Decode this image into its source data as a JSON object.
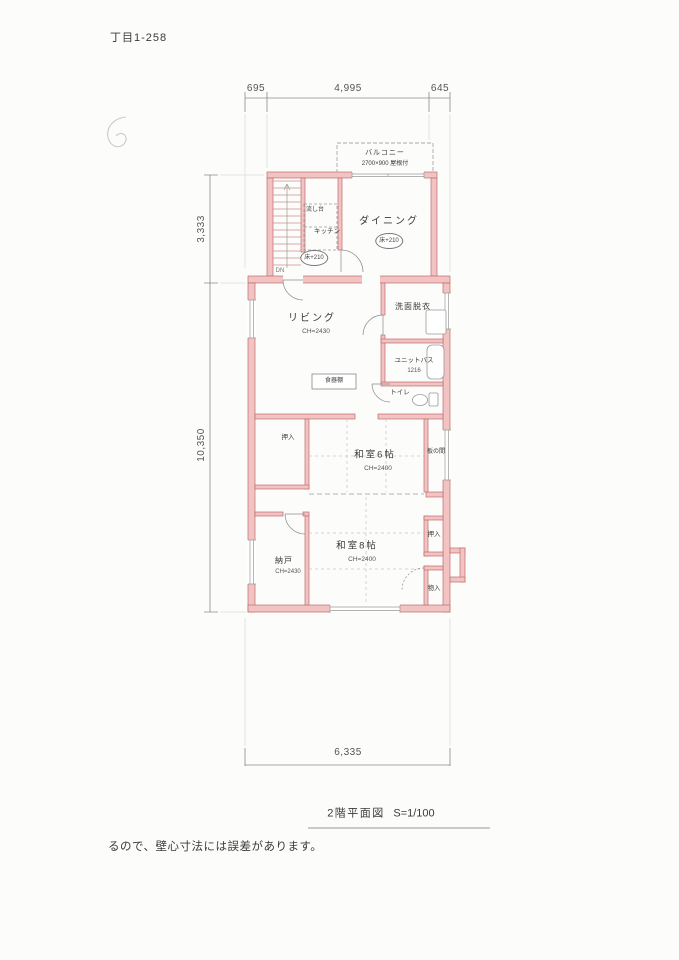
{
  "page": {
    "doc_number": "丁目1-258",
    "title": "2階平面図",
    "scale": "S=1/100",
    "footer_note": "るので、壁心寸法には誤差があります。"
  },
  "dimensions": {
    "top": [
      "695",
      "4,995",
      "645"
    ],
    "left": [
      "3,333",
      "10,350"
    ],
    "bottom": [
      "6,335"
    ]
  },
  "labels": {
    "balcony_name": "バルコニー",
    "balcony_size": "2700×900  屋根付",
    "dining": "ダイニング",
    "kitchen": "キッチン",
    "sink": "流し台",
    "floor_level": "床+210",
    "stairs_dn": "DN",
    "living": "リビング",
    "living_ch": "CH=2430",
    "washroom": "洗面脱衣",
    "bath": "ユニットバス",
    "bath_size": "1216",
    "toilet": "トイレ",
    "cupboard": "食器棚",
    "oshiire": "押入",
    "washitsu6": "和室6帖",
    "washitsu6_ch": "CH=2400",
    "itanoma": "板の間",
    "washitsu8": "和室8帖",
    "washitsu8_ch": "CH=2400",
    "nando": "納戸",
    "nando_ch": "CH=2430",
    "monoire": "物入"
  },
  "colors": {
    "wall_fill": "#f2c3c3",
    "wall_line": "#c06c6c",
    "stair_line": "#c9908f",
    "drawing_line": "#8a8a8a",
    "text": "#3a3a3a"
  }
}
